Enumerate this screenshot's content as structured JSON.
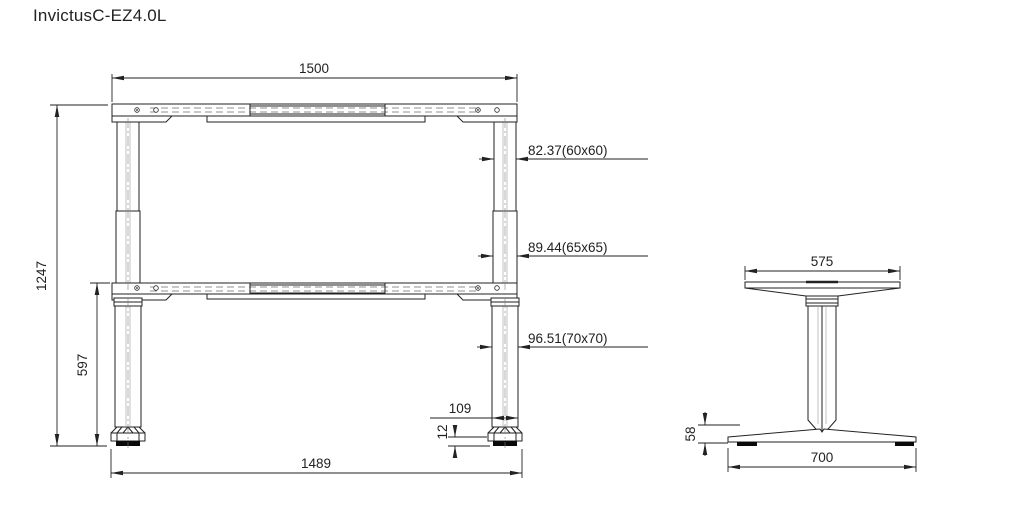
{
  "title": "InvictusC-EZ4.0L",
  "colors": {
    "line": "#222222",
    "pad_fill": "#0a0a0a",
    "background": "#ffffff"
  },
  "front_view": {
    "dims": {
      "frame_width": "1500",
      "overall_height": "1247",
      "lower_column_height": "597",
      "upper_column_profile": "82.37(60x60)",
      "middle_column_profile": "89.44(65x65)",
      "lower_column_profile": "96.51(70x70)",
      "foot_cap_width": "109",
      "foot_pad_height": "12",
      "foot_span": "1489"
    }
  },
  "side_view": {
    "dims": {
      "top_bracket_width": "575",
      "foot_height": "58",
      "foot_depth": "700"
    }
  }
}
